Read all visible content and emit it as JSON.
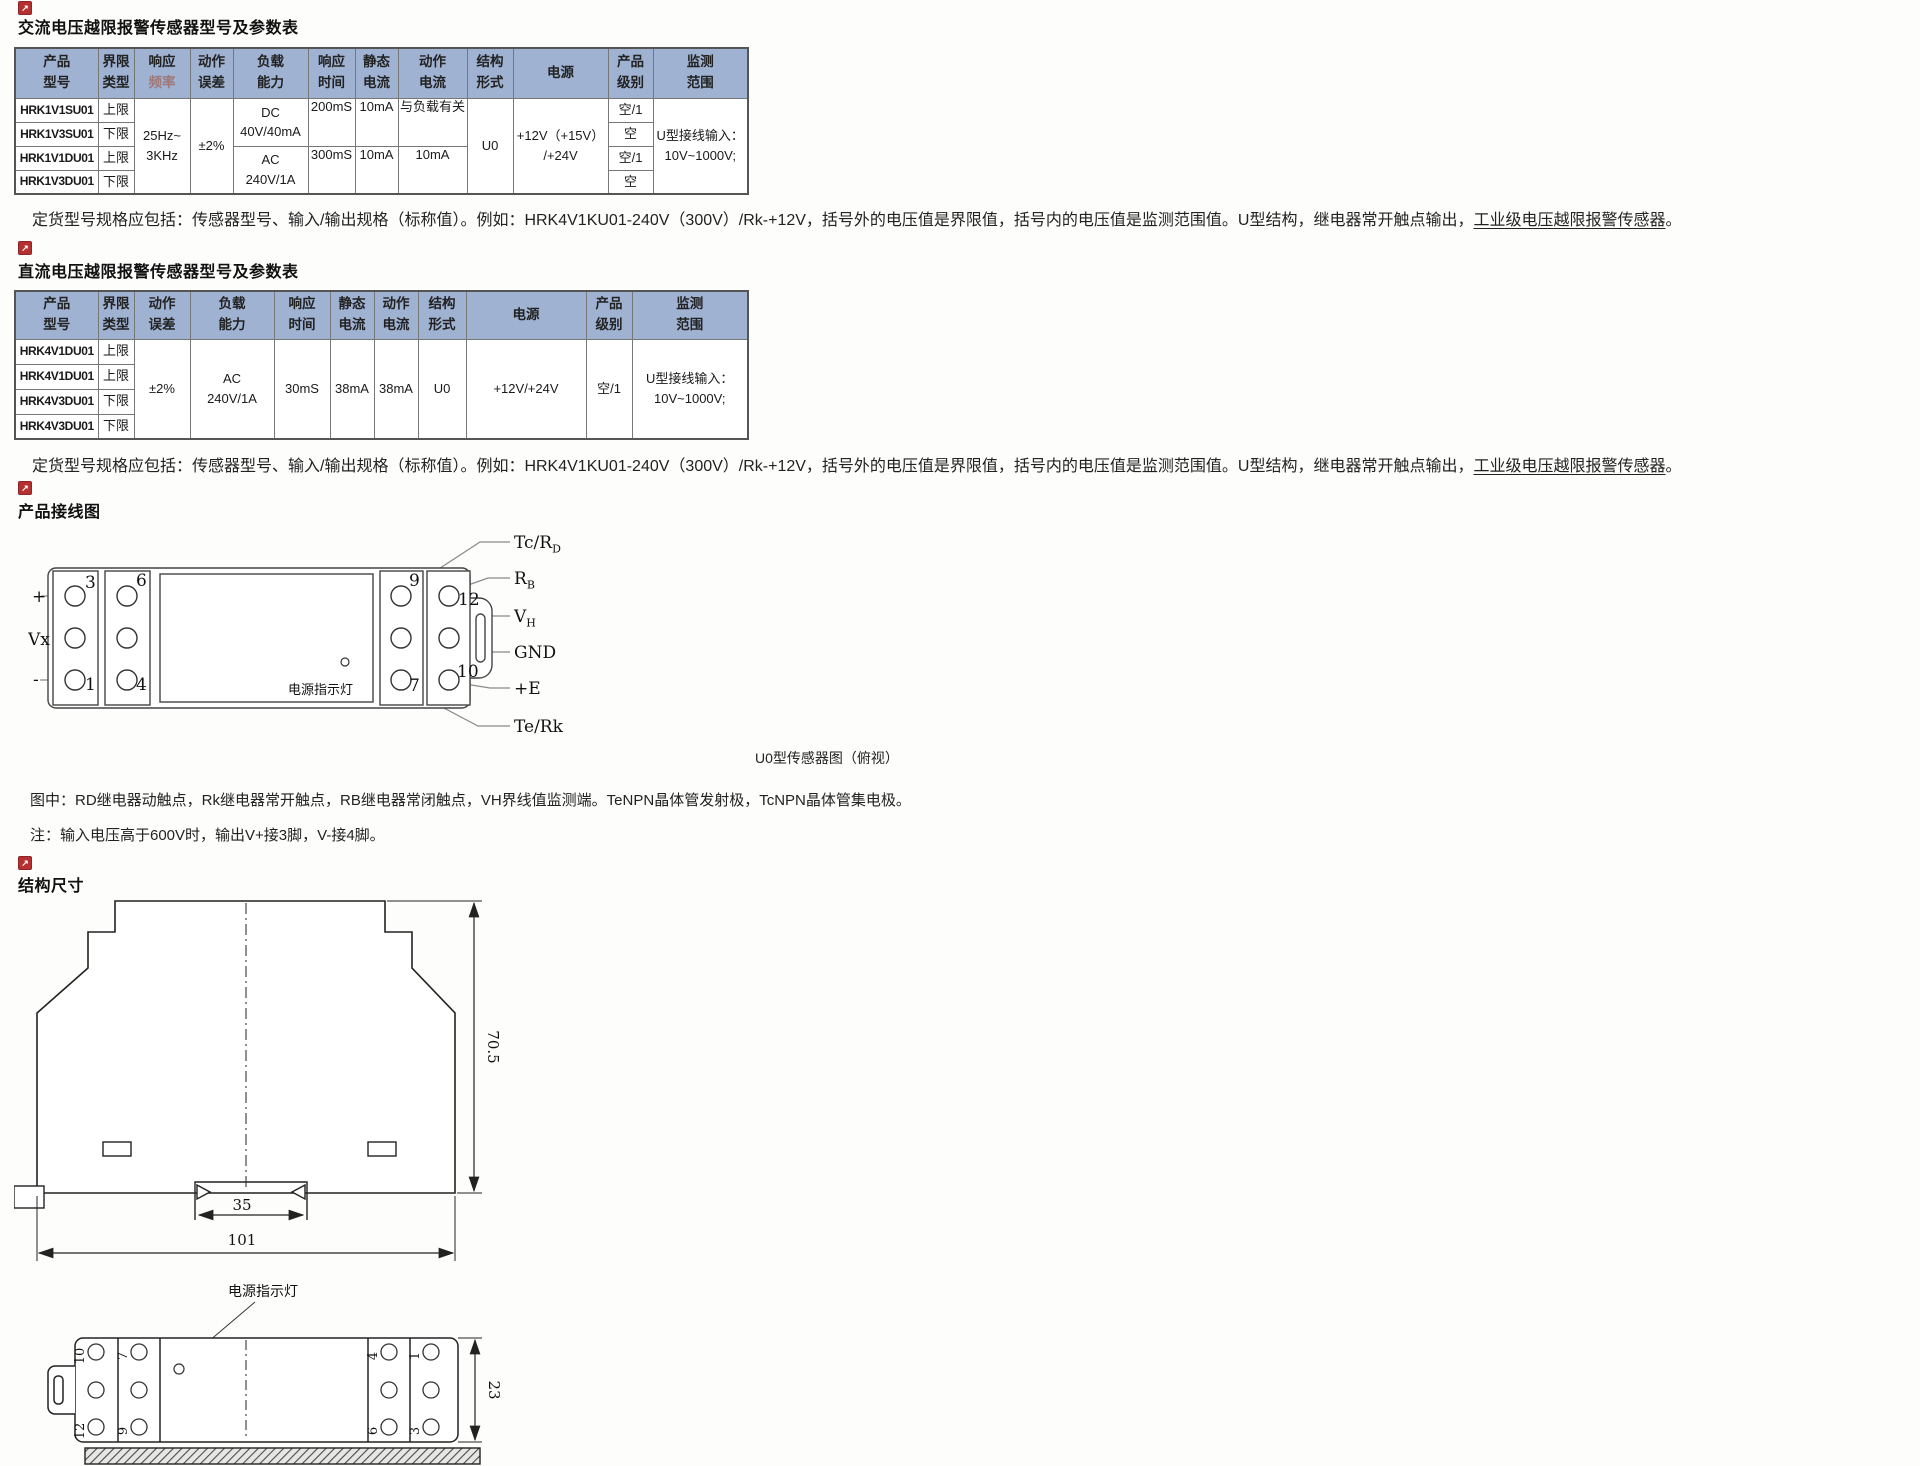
{
  "icons": {
    "bullet_glyph": "↗"
  },
  "colors": {
    "header_bg": "#9fb2d2",
    "accent_red": "#b53030"
  },
  "section_ac": {
    "title": "交流电压越限报警传感器型号及参数表",
    "note": {
      "prefix": "定货型号规格应包括：传感器型号、输入/输出规格（标称值）。例如：HRK4V1KU01-240V（300V）/Rk-+12V，括号外的电压值是界限值，括号内的电压值是监测范围值。U型结构，继电器常开触点输出，",
      "underlined": "工业级电压越限报警传感器",
      "suffix": "。"
    },
    "table": {
      "headers": [
        {
          "a": "产品",
          "b": "型号"
        },
        {
          "a": "界限",
          "b": "类型"
        },
        {
          "a": "响应",
          "b": "频率"
        },
        {
          "a": "动作",
          "b": "误差"
        },
        {
          "a": "负载",
          "b": "能力"
        },
        {
          "a": "响应",
          "b": "时间"
        },
        {
          "a": "静态",
          "b": "电流"
        },
        {
          "a": "动作",
          "b": "电流"
        },
        {
          "a": "结构",
          "b": "形式"
        },
        {
          "a": "电源",
          "b": ""
        },
        {
          "a": "产品",
          "b": "级别"
        },
        {
          "a": "监测",
          "b": "范围"
        }
      ],
      "models": [
        "HRK1V1SU01",
        "HRK1V3SU01",
        "HRK1V1DU01",
        "HRK1V3DU01"
      ],
      "limits": [
        "上限",
        "下限",
        "上限",
        "下限"
      ],
      "freq": {
        "a": "25Hz~",
        "b": "3KHz"
      },
      "error": "±2%",
      "load_dc": {
        "a": "DC",
        "b": "40V/40mA"
      },
      "load_ac": {
        "a": "AC",
        "b": "240V/1A"
      },
      "time_1": "200mS",
      "time_2": "300mS",
      "static_1": "10mA",
      "static_2": "10mA",
      "action_1": "与负载有关",
      "action_2": "10mA",
      "structure": "U0",
      "power": {
        "a": "+12V（+15V）",
        "b": "/+24V"
      },
      "grades": [
        "空/1",
        "空",
        "空/1",
        "空"
      ],
      "range": {
        "a": "U型接线输入：",
        "b": "10V~1000V;"
      }
    }
  },
  "section_dc": {
    "title": "直流电压越限报警传感器型号及参数表",
    "note": {
      "prefix": "定货型号规格应包括：传感器型号、输入/输出规格（标称值）。例如：HRK4V1KU01-240V（300V）/Rk-+12V，括号外的电压值是界限值，括号内的电压值是监测范围值。U型结构，继电器常开触点输出，",
      "underlined": "工业级电压越限报警传感器",
      "suffix": "。"
    },
    "table": {
      "headers": [
        {
          "a": "产品",
          "b": "型号"
        },
        {
          "a": "界限",
          "b": "类型"
        },
        {
          "a": "动作",
          "b": "误差"
        },
        {
          "a": "负载",
          "b": "能力"
        },
        {
          "a": "响应",
          "b": "时间"
        },
        {
          "a": "静态",
          "b": "电流"
        },
        {
          "a": "动作",
          "b": "电流"
        },
        {
          "a": "结构",
          "b": "形式"
        },
        {
          "a": "电源",
          "b": ""
        },
        {
          "a": "产品",
          "b": "级别"
        },
        {
          "a": "监测",
          "b": "范围"
        }
      ],
      "models": [
        "HRK4V1DU01",
        "HRK4V1DU01",
        "HRK4V3DU01",
        "HRK4V3DU01"
      ],
      "limits": [
        "上限",
        "上限",
        "下限",
        "下限"
      ],
      "error": "±2%",
      "load": {
        "a": "AC",
        "b": "240V/1A"
      },
      "time": "30mS",
      "static": "38mA",
      "action": "38mA",
      "structure": "U0",
      "power": "+12V/+24V",
      "grade": "空/1",
      "range": {
        "a": "U型接线输入：",
        "b": "10V~1000V;"
      }
    }
  },
  "wiring": {
    "title": "产品接线图",
    "caption": "U0型传感器图（俯视）",
    "legend": "图中：RD继电器动触点，Rk继电器常开触点，RB继电器常闭触点，VH界线值监测端。TeNPN晶体管发射极，TcNPN晶体管集电极。",
    "note": "注：输入电压高于600V时，输出V+接3脚，V-接4脚。",
    "led_label": "电源指示灯",
    "input_labels": {
      "plus": "+",
      "vx": "Vx",
      "minus": "-"
    },
    "pins": {
      "p3": "3",
      "p6": "6",
      "p1": "1",
      "p4": "4",
      "p9": "9",
      "p12": "12",
      "p7": "7",
      "p10": "10"
    },
    "outputs": [
      {
        "main": "Tc/R",
        "sub": "D"
      },
      {
        "main": "R",
        "sub": "B"
      },
      {
        "main": "V",
        "sub": "H"
      },
      {
        "main": "GND",
        "sub": ""
      },
      {
        "main": "+E",
        "sub": ""
      },
      {
        "main": "Te/Rk",
        "sub": ""
      }
    ]
  },
  "dimensions": {
    "title": "结构尺寸",
    "height": "70.5",
    "rail_notch": "35",
    "width": "101",
    "depth": "23",
    "led_label": "电源指示灯",
    "top_view_pins_left": [
      "10",
      "7",
      "12",
      "9"
    ],
    "top_view_pins_right": [
      "4",
      "1",
      "6",
      "3"
    ]
  }
}
